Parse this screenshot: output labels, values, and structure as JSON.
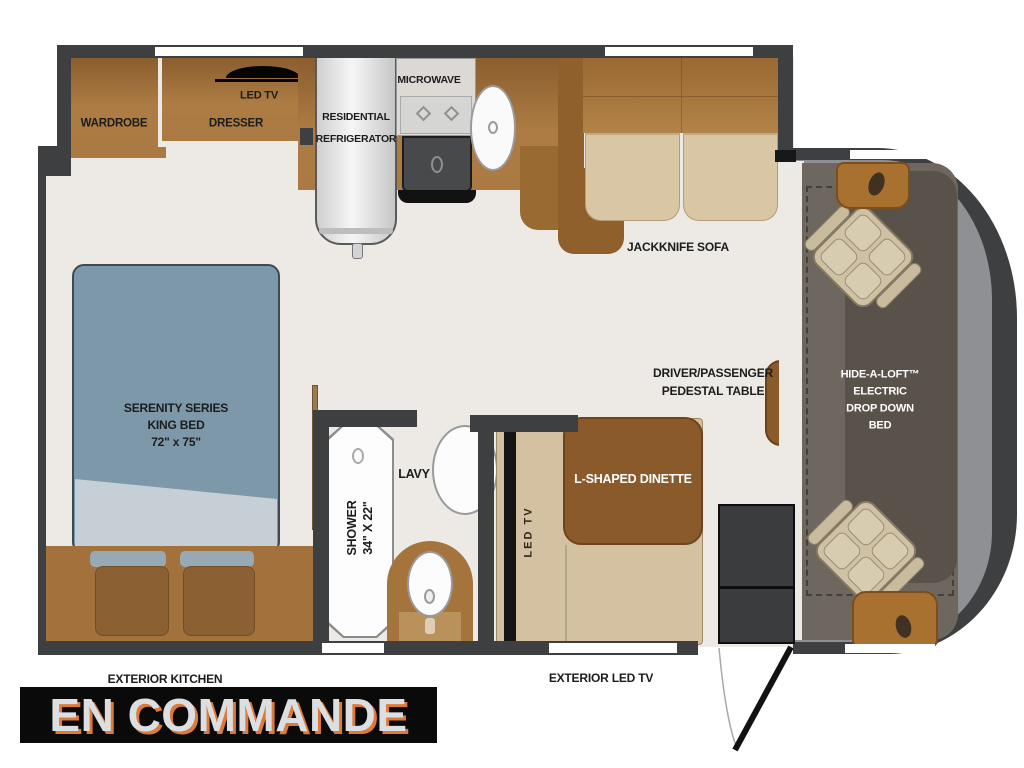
{
  "floorplan": {
    "labels": {
      "wardrobe": "WARDROBE",
      "dresser": "DRESSER",
      "bedroom_led_tv": "LED TV",
      "refrigerator": [
        "RESIDENTIAL",
        "REFRIGERATOR"
      ],
      "microwave": "MICROWAVE",
      "jackknife_sofa": "JACKKNIFE SOFA",
      "king_bed": [
        "SERENITY SERIES",
        "KING BED",
        "72\" x 75\""
      ],
      "shower": [
        "SHOWER",
        "34\" X 22\""
      ],
      "lavy": "LAVY",
      "dinette_led_tv": "LED TV",
      "l_shaped_dinette": "L-SHAPED DINETTE",
      "pedestal_table": [
        "DRIVER/PASSENGER",
        "PEDESTAL TABLE"
      ],
      "hide_a_loft": [
        "HIDE-A-LOFT™",
        "ELECTRIC",
        "DROP DOWN",
        "BED"
      ],
      "exterior_kitchen": "EXTERIOR KITCHEN",
      "exterior_led_tv": "EXTERIOR LED TV"
    },
    "banner": {
      "text": "EN COMMANDE",
      "background": "#0a0a0a",
      "text_color": "#dbdfe2",
      "shadow_color": "#dd7a38"
    },
    "colors": {
      "wall": "#3e3f41",
      "floor": "#edeae5",
      "cabinet_brown": "#aa7a42",
      "table_brown": "#8a5a2b",
      "bench_tan": "#d4c1a1",
      "bed_blue": "#7d98a9",
      "cab_gray": "#8e9094",
      "cab_interior": "#6e675f"
    }
  }
}
